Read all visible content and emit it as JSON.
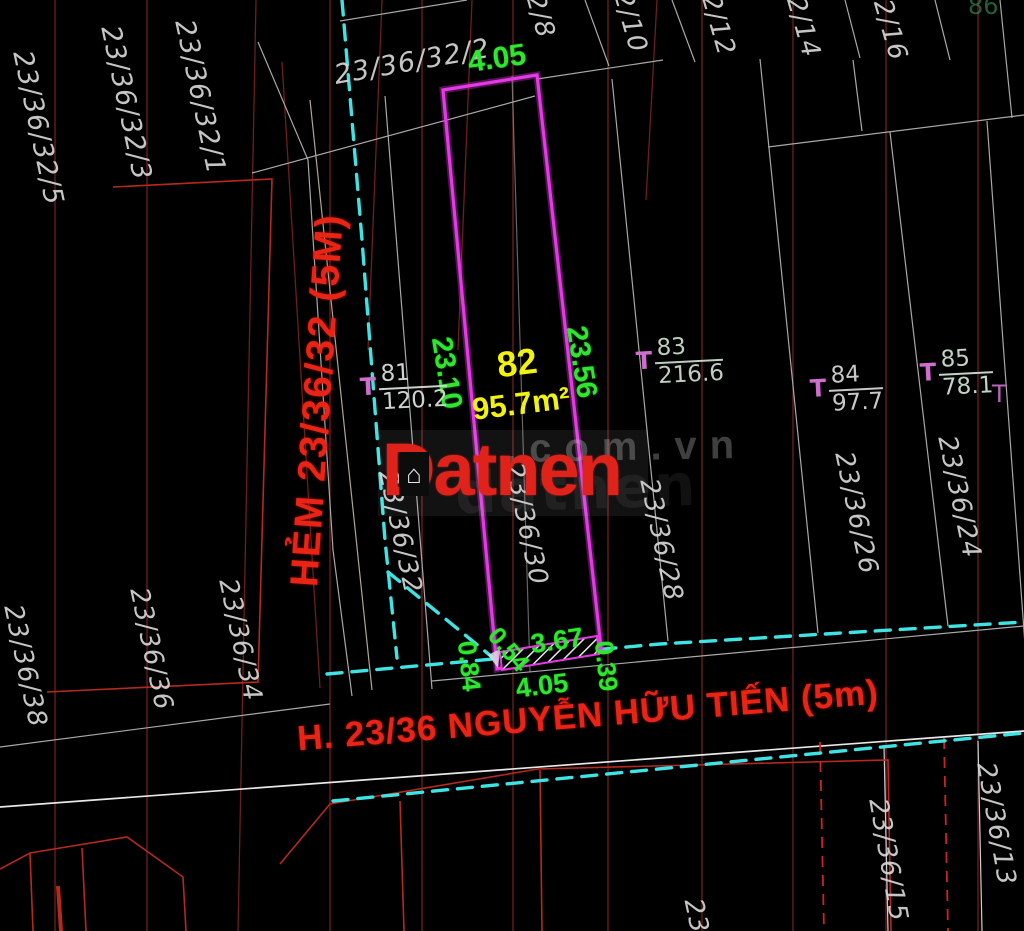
{
  "canvas": {
    "width": 1024,
    "height": 931
  },
  "colors": {
    "background": "#000000",
    "plot_outline_magenta": "#e43ae4",
    "dimension_green": "#2ee62e",
    "plot_label_yellow": "#f2f20e",
    "street_red": "#ea2415",
    "grid_dark_red": "#6e1e1e",
    "boundary_bright_red": "#b5291f",
    "cad_line_gray": "#a8a8a8",
    "survey_dash_cyan": "#3fe3e3",
    "survey_mark_magenta": "#cf6ecf",
    "label_white": "#d6d6d6",
    "watermark_gray": "#9b9b9b"
  },
  "plot": {
    "number": "82",
    "area": "95.7m²"
  },
  "streets": {
    "hem": "HẺM 23/36/32 (5M)",
    "main": "H. 23/36 NGUYỄN HỮU TIẾN (5m)"
  },
  "watermark": {
    "logo": "Datnen",
    "domain": ".com.vn",
    "ghost": "datnen",
    "house_icon": "⌂"
  },
  "dimensions": [
    {
      "text": "4.05",
      "x": 497,
      "y": 59,
      "rot": -8,
      "size": 30
    },
    {
      "text": "23.10",
      "x": 446,
      "y": 373,
      "rot": 81,
      "size": 29
    },
    {
      "text": "23.56",
      "x": 581,
      "y": 362,
      "rot": 81,
      "size": 29
    },
    {
      "text": "0.84",
      "x": 469,
      "y": 666,
      "rot": 84,
      "size": 26
    },
    {
      "text": "0.54",
      "x": 508,
      "y": 650,
      "rot": 50,
      "size": 25
    },
    {
      "text": "3.67",
      "x": 557,
      "y": 641,
      "rot": -8,
      "size": 27
    },
    {
      "text": "0.39",
      "x": 606,
      "y": 666,
      "rot": 84,
      "size": 26
    },
    {
      "text": "4.05",
      "x": 542,
      "y": 686,
      "rot": -7,
      "size": 27
    }
  ],
  "parcel_labels": [
    {
      "text": "23/36/32/2",
      "x": 412,
      "y": 62,
      "rot": -10,
      "size": 27
    },
    {
      "text": "2/8",
      "x": 540,
      "y": 16,
      "rot": 74,
      "size": 26
    },
    {
      "text": "2/10",
      "x": 630,
      "y": 22,
      "rot": 74,
      "size": 26
    },
    {
      "text": "2/12",
      "x": 718,
      "y": 25,
      "rot": 74,
      "size": 26
    },
    {
      "text": "2/14",
      "x": 803,
      "y": 27,
      "rot": 74,
      "size": 26
    },
    {
      "text": "2/16",
      "x": 890,
      "y": 30,
      "rot": 74,
      "size": 26
    },
    {
      "text": "23/36/32/5",
      "x": 38,
      "y": 128,
      "rot": 78,
      "size": 27
    },
    {
      "text": "23/36/32/3",
      "x": 126,
      "y": 103,
      "rot": 78,
      "size": 27
    },
    {
      "text": "23/36/32/1",
      "x": 200,
      "y": 97,
      "rot": 78,
      "size": 27
    },
    {
      "text": "23/36/32",
      "x": 400,
      "y": 532,
      "rot": 78,
      "size": 26
    },
    {
      "text": "23/36/30",
      "x": 526,
      "y": 524,
      "rot": 78,
      "size": 26
    },
    {
      "text": "23/36/28",
      "x": 661,
      "y": 540,
      "rot": 78,
      "size": 26
    },
    {
      "text": "23/36/26",
      "x": 856,
      "y": 513,
      "rot": 78,
      "size": 26
    },
    {
      "text": "23/36/24",
      "x": 959,
      "y": 497,
      "rot": 78,
      "size": 26
    },
    {
      "text": "23/36/38",
      "x": 25,
      "y": 666,
      "rot": 78,
      "size": 26
    },
    {
      "text": "23/36/36",
      "x": 151,
      "y": 649,
      "rot": 78,
      "size": 26
    },
    {
      "text": "23/36/34",
      "x": 240,
      "y": 640,
      "rot": 78,
      "size": 26
    },
    {
      "text": "23/36/15",
      "x": 888,
      "y": 860,
      "rot": 80,
      "size": 26
    },
    {
      "text": "23/36/13",
      "x": 996,
      "y": 824,
      "rot": 80,
      "size": 26
    },
    {
      "text": "23",
      "x": 696,
      "y": 916,
      "rot": 78,
      "size": 26
    }
  ],
  "survey_marks": [
    {
      "parcel": "81",
      "area": "120.2",
      "x": 360,
      "y": 362,
      "tint": "#ccd3cc"
    },
    {
      "parcel": "83",
      "area": "216.6",
      "x": 636,
      "y": 336,
      "tint": "#becebe"
    },
    {
      "parcel": "84",
      "area": "97.7",
      "x": 810,
      "y": 364,
      "tint": "#c8c8c8"
    },
    {
      "parcel": "85",
      "area": "78.1",
      "x": 920,
      "y": 348,
      "tint": "#c3d3c3"
    }
  ],
  "fragments": [
    {
      "text": "T",
      "x": 992,
      "y": 380,
      "color": "#cf6ecf",
      "size": 24,
      "opacity": 0.9
    },
    {
      "text": "86",
      "x": 968,
      "y": -8,
      "color": "#3fae5e",
      "size": 24,
      "opacity": 0.55
    }
  ]
}
